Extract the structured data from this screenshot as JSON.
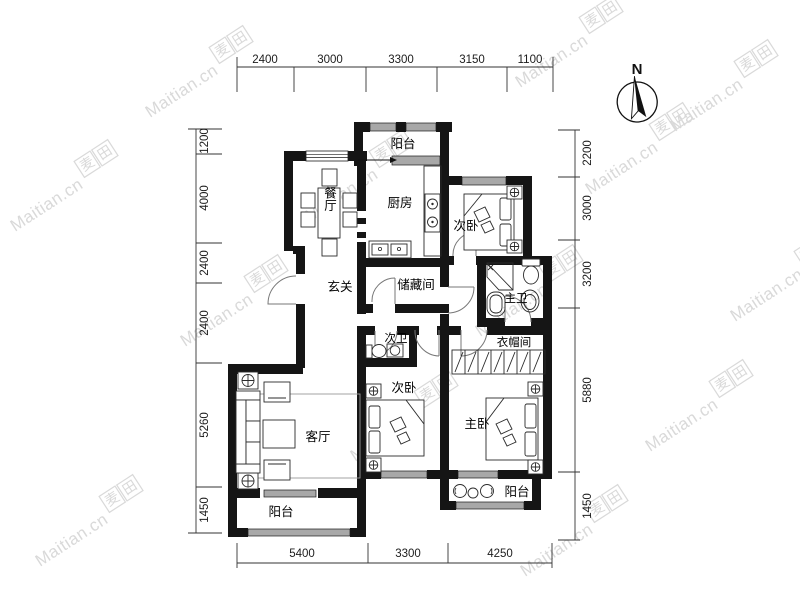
{
  "watermark": {
    "brand": "Maitian.cn",
    "logo": "麦田",
    "logo_char_1": "麦",
    "logo_char_2": "田"
  },
  "compass": {
    "north_label": "N"
  },
  "colors": {
    "wall": "#151515",
    "window_fill": "#a8a8a8",
    "dimension": "#1c1c1c",
    "watermark": "#d9d9d9"
  },
  "rooms": {
    "balcony_north": "阳台",
    "kitchen": "厨房",
    "dining": "餐厅",
    "bedroom_ne": "次卧",
    "foyer": "玄关",
    "storage": "储藏间",
    "master_bath": "主卫",
    "second_bath": "次卫",
    "cloakroom": "衣帽间",
    "bedroom_mid": "次卧",
    "master_bedroom": "主卧",
    "living_room": "客厅",
    "balcony_sw": "阳台",
    "balcony_se": "阳台"
  },
  "dimensions": {
    "top": [
      "2400",
      "3000",
      "3300",
      "3150",
      "1100"
    ],
    "bottom": [
      "5400",
      "3300",
      "4250"
    ],
    "left": [
      "1200",
      "4000",
      "2400",
      "2400",
      "5260",
      "1450"
    ],
    "right": [
      "2200",
      "3000",
      "3200",
      "5880",
      "1450"
    ]
  }
}
